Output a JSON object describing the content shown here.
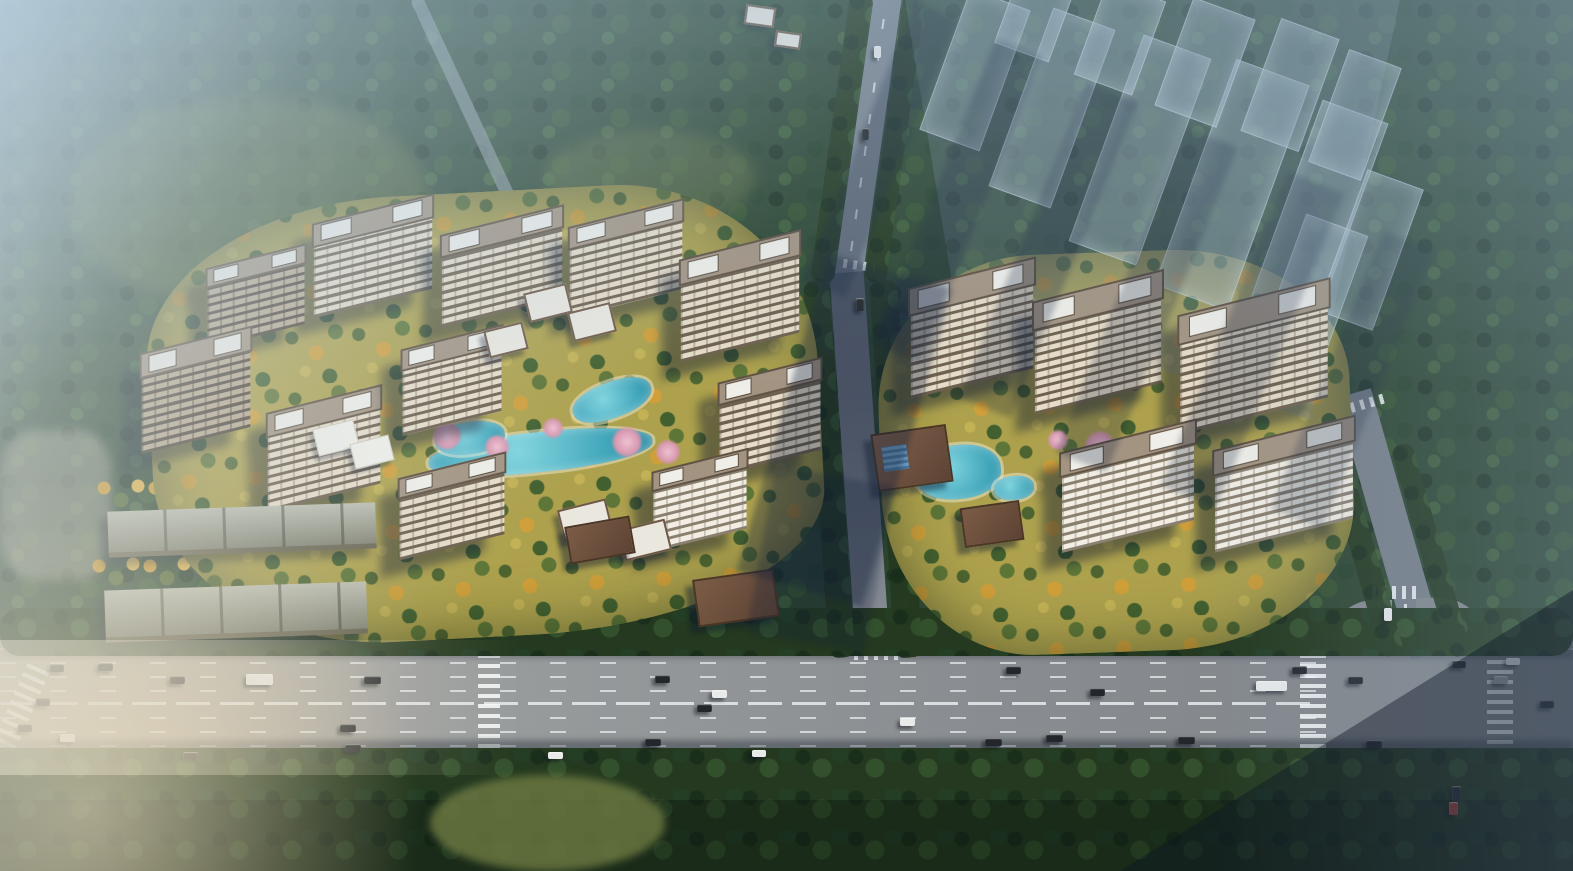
{
  "scene": {
    "title": "Aerial dusk rendering of a two-cluster residential development masterplan beside an urban boulevard",
    "view": "oblique aerial architectural visualization",
    "palette": {
      "forest": "#2c4530",
      "forestDark": "#1e3423",
      "canopyHi": "#3c5c37",
      "meadow": "#5c6c3e",
      "hazeSky": "#cde1ee",
      "hazeBlue": "#94b2cb",
      "roadGray": "#868d93",
      "roadDark": "#59616f",
      "roadWarm": "#b6aa98",
      "laneWhite": "#e8ecee",
      "groundGold": "#ada14d",
      "treeGold": "#cf9a2e",
      "treeGreen": "#4c632f",
      "waterTeal": "#3da3b8",
      "blossomPink": "#d795ad",
      "towerFace": "#e6dcc8",
      "towerDark": "#6e604e",
      "towerRoof": "#a39482",
      "roofWhite": "#efeee8",
      "shedRoof": "#a3a591",
      "ghostFill": "rgba(150,170,186,0.40)",
      "shadowNavy": "rgba(20,33,56,0.35)",
      "carWhite": "#e8eaea",
      "carDark": "#23272c",
      "carGray": "#9aa2a8",
      "carRed": "#9c3a32",
      "glareWarm": "#f3deb4"
    },
    "clusters": [
      {
        "id": "west",
        "towers": 11,
        "features": [
          "winding turquoise ponds",
          "golden trees",
          "blossom trees",
          "white-roof villas",
          "courts",
          "south gate pavilion"
        ]
      },
      {
        "id": "east",
        "towers": 5,
        "features": [
          "clubhouse with glass roof",
          "swimming pool",
          "gate pavilion",
          "tree-clump lawn"
        ]
      }
    ],
    "buildings": [
      {
        "kind": "tower",
        "cx": 373,
        "cy": 256,
        "w": 122,
        "h": 92,
        "rot": -14,
        "tone": "light"
      },
      {
        "kind": "tower",
        "cx": 502,
        "cy": 266,
        "w": 124,
        "h": 90,
        "rot": -14,
        "tone": "light"
      },
      {
        "kind": "tower",
        "cx": 626,
        "cy": 258,
        "w": 116,
        "h": 88,
        "rot": -14,
        "tone": "light"
      },
      {
        "kind": "tower",
        "cx": 256,
        "cy": 296,
        "w": 100,
        "h": 78,
        "rot": -14,
        "tone": "dark"
      },
      {
        "kind": "tower",
        "cx": 196,
        "cy": 390,
        "w": 112,
        "h": 98,
        "rot": -14,
        "tone": "dark"
      },
      {
        "kind": "tower",
        "cx": 324,
        "cy": 448,
        "w": 116,
        "h": 96,
        "rot": -14,
        "tone": "light"
      },
      {
        "kind": "tower",
        "cx": 452,
        "cy": 380,
        "w": 102,
        "h": 84,
        "rot": -14,
        "tone": "light"
      },
      {
        "kind": "tower",
        "cx": 740,
        "cy": 296,
        "w": 122,
        "h": 100,
        "rot": -14,
        "tone": "light"
      },
      {
        "kind": "tower",
        "cx": 770,
        "cy": 416,
        "w": 104,
        "h": 90,
        "rot": -14,
        "tone": "light"
      },
      {
        "kind": "tower",
        "cx": 700,
        "cy": 500,
        "w": 96,
        "h": 78,
        "rot": -14,
        "tone": "bright"
      },
      {
        "kind": "tower",
        "cx": 452,
        "cy": 506,
        "w": 108,
        "h": 80,
        "rot": -14,
        "tone": "light"
      },
      {
        "kind": "tower",
        "cx": 972,
        "cy": 328,
        "w": 126,
        "h": 108,
        "rot": -14,
        "tone": "light"
      },
      {
        "kind": "tower",
        "cx": 1098,
        "cy": 342,
        "w": 130,
        "h": 110,
        "rot": -14,
        "tone": "light"
      },
      {
        "kind": "tower",
        "cx": 1254,
        "cy": 356,
        "w": 152,
        "h": 116,
        "rot": -14,
        "tone": "light"
      },
      {
        "kind": "tower",
        "cx": 1128,
        "cy": 486,
        "w": 136,
        "h": 98,
        "rot": -14,
        "tone": "bright"
      },
      {
        "kind": "tower",
        "cx": 1284,
        "cy": 484,
        "w": 142,
        "h": 100,
        "rot": -14,
        "tone": "bright"
      },
      {
        "kind": "villa",
        "cx": 548,
        "cy": 303,
        "w": 44,
        "h": 30,
        "rot": -14
      },
      {
        "kind": "villa",
        "cx": 592,
        "cy": 322,
        "w": 44,
        "h": 30,
        "rot": -14
      },
      {
        "kind": "villa",
        "cx": 506,
        "cy": 340,
        "w": 40,
        "h": 28,
        "rot": -14
      },
      {
        "kind": "villa",
        "cx": 585,
        "cy": 520,
        "w": 50,
        "h": 32,
        "rot": -14
      },
      {
        "kind": "villa",
        "cx": 645,
        "cy": 540,
        "w": 48,
        "h": 32,
        "rot": -14
      },
      {
        "kind": "villa",
        "cx": 760,
        "cy": 16,
        "w": 30,
        "h": 20,
        "rot": 8
      },
      {
        "kind": "villa",
        "cx": 788,
        "cy": 40,
        "w": 26,
        "h": 16,
        "rot": 8
      },
      {
        "kind": "court",
        "cx": 336,
        "cy": 438,
        "w": 42,
        "h": 28,
        "rot": -14
      },
      {
        "kind": "court",
        "cx": 372,
        "cy": 452,
        "w": 40,
        "h": 26,
        "rot": -14
      },
      {
        "kind": "gate",
        "cx": 600,
        "cy": 540,
        "w": 66,
        "h": 38,
        "rot": -10
      },
      {
        "kind": "gate",
        "cx": 736,
        "cy": 598,
        "w": 82,
        "h": 48,
        "rot": -8
      },
      {
        "kind": "gate",
        "cx": 992,
        "cy": 524,
        "w": 60,
        "h": 40,
        "rot": -8
      },
      {
        "kind": "clubhouse",
        "cx": 912,
        "cy": 458,
        "w": 76,
        "h": 58,
        "rot": -8
      },
      {
        "kind": "shed",
        "cx": 242,
        "cy": 530,
        "w": 268,
        "h": 46,
        "rot": -2
      },
      {
        "kind": "shed",
        "cx": 236,
        "cy": 612,
        "w": 262,
        "h": 52,
        "rot": -2
      }
    ],
    "ghost_blocks": [
      {
        "cx": 975,
        "cy": 70,
        "w": 64,
        "h": 150,
        "rot": 20
      },
      {
        "cx": 1052,
        "cy": 108,
        "w": 66,
        "h": 190,
        "rot": 20
      },
      {
        "cx": 1140,
        "cy": 150,
        "w": 72,
        "h": 220,
        "rot": 20
      },
      {
        "cx": 1232,
        "cy": 185,
        "w": 78,
        "h": 240,
        "rot": 20
      },
      {
        "cx": 1318,
        "cy": 215,
        "w": 70,
        "h": 220,
        "rot": 20
      },
      {
        "cx": 1035,
        "cy": 15,
        "w": 58,
        "h": 80,
        "rot": 20
      },
      {
        "cx": 1120,
        "cy": 38,
        "w": 62,
        "h": 100,
        "rot": 20
      },
      {
        "cx": 1205,
        "cy": 62,
        "w": 66,
        "h": 115,
        "rot": 20
      },
      {
        "cx": 1290,
        "cy": 85,
        "w": 62,
        "h": 120,
        "rot": 20
      },
      {
        "cx": 1355,
        "cy": 115,
        "w": 56,
        "h": 120,
        "rot": 20
      },
      {
        "cx": 1310,
        "cy": 300,
        "w": 66,
        "h": 160,
        "rot": 20
      },
      {
        "cx": 1370,
        "cy": 250,
        "w": 60,
        "h": 150,
        "rot": 20
      }
    ],
    "shadow_bands": [
      {
        "cx": 880,
        "cy": 150,
        "w": 46,
        "h": 300,
        "rot": 22,
        "op": 0.3
      },
      {
        "cx": 958,
        "cy": 200,
        "w": 50,
        "h": 330,
        "rot": 22,
        "op": 0.28
      },
      {
        "cx": 1048,
        "cy": 250,
        "w": 55,
        "h": 340,
        "rot": 22,
        "op": 0.28
      },
      {
        "cx": 1146,
        "cy": 300,
        "w": 55,
        "h": 350,
        "rot": 22,
        "op": 0.26
      },
      {
        "cx": 1252,
        "cy": 340,
        "w": 60,
        "h": 340,
        "rot": 22,
        "op": 0.26
      },
      {
        "cx": 1352,
        "cy": 380,
        "w": 55,
        "h": 300,
        "rot": 22,
        "op": 0.24
      },
      {
        "cx": 845,
        "cy": 430,
        "w": 130,
        "h": 330,
        "rot": 16,
        "op": 0.36
      },
      {
        "cx": 820,
        "cy": 560,
        "w": 120,
        "h": 170,
        "rot": 10,
        "op": 0.26
      }
    ],
    "water": [
      {
        "cx": 540,
        "cy": 452,
        "w": 225,
        "h": 40,
        "rot": -6
      },
      {
        "cx": 612,
        "cy": 400,
        "w": 82,
        "h": 36,
        "rot": -20
      },
      {
        "cx": 470,
        "cy": 438,
        "w": 70,
        "h": 32,
        "rot": -8
      },
      {
        "cx": 958,
        "cy": 472,
        "w": 86,
        "h": 54,
        "rot": -6
      },
      {
        "cx": 1014,
        "cy": 488,
        "w": 40,
        "h": 24,
        "rot": -6
      }
    ],
    "blossoms": [
      {
        "cx": 447,
        "cy": 436,
        "r": 14
      },
      {
        "cx": 497,
        "cy": 447,
        "r": 12
      },
      {
        "cx": 627,
        "cy": 442,
        "r": 15
      },
      {
        "cx": 668,
        "cy": 452,
        "r": 12
      },
      {
        "cx": 553,
        "cy": 428,
        "r": 10
      },
      {
        "cx": 1100,
        "cy": 446,
        "r": 15
      },
      {
        "cx": 1058,
        "cy": 440,
        "r": 10
      }
    ],
    "vehicles": [
      {
        "x": 98,
        "y": 663,
        "w": 15,
        "h": 8,
        "c": "carDark"
      },
      {
        "x": 170,
        "y": 676,
        "w": 15,
        "h": 8,
        "c": "carDark"
      },
      {
        "x": 246,
        "y": 674,
        "w": 27,
        "h": 11,
        "c": "carWhite"
      },
      {
        "x": 364,
        "y": 676,
        "w": 17,
        "h": 8,
        "c": "carDark"
      },
      {
        "x": 655,
        "y": 675,
        "w": 15,
        "h": 8,
        "c": "carDark"
      },
      {
        "x": 712,
        "y": 690,
        "w": 15,
        "h": 8,
        "c": "carWhite"
      },
      {
        "x": 697,
        "y": 704,
        "w": 15,
        "h": 8,
        "c": "carDark"
      },
      {
        "x": 1006,
        "y": 666,
        "w": 15,
        "h": 8,
        "c": "carDark"
      },
      {
        "x": 1090,
        "y": 688,
        "w": 15,
        "h": 8,
        "c": "carDark"
      },
      {
        "x": 1292,
        "y": 666,
        "w": 15,
        "h": 8,
        "c": "carDark"
      },
      {
        "x": 1348,
        "y": 676,
        "w": 15,
        "h": 8,
        "c": "carDark"
      },
      {
        "x": 1452,
        "y": 660,
        "w": 14,
        "h": 8,
        "c": "carDark"
      },
      {
        "x": 1506,
        "y": 658,
        "w": 14,
        "h": 7,
        "c": "carWhite"
      },
      {
        "x": 1494,
        "y": 676,
        "w": 14,
        "h": 8,
        "c": "carGray"
      },
      {
        "x": 1540,
        "y": 700,
        "w": 14,
        "h": 8,
        "c": "carDark"
      },
      {
        "x": 50,
        "y": 664,
        "w": 14,
        "h": 8,
        "c": "carDark"
      },
      {
        "x": 36,
        "y": 698,
        "w": 14,
        "h": 8,
        "c": "carDark"
      },
      {
        "x": 18,
        "y": 724,
        "w": 14,
        "h": 8,
        "c": "carDark"
      },
      {
        "x": 60,
        "y": 734,
        "w": 15,
        "h": 8,
        "c": "carWhite"
      },
      {
        "x": 340,
        "y": 724,
        "w": 16,
        "h": 8,
        "c": "carDark"
      },
      {
        "x": 345,
        "y": 744,
        "w": 16,
        "h": 8,
        "c": "carDark"
      },
      {
        "x": 183,
        "y": 752,
        "w": 15,
        "h": 7,
        "c": "carDark"
      },
      {
        "x": 548,
        "y": 752,
        "w": 15,
        "h": 7,
        "c": "carWhite"
      },
      {
        "x": 645,
        "y": 738,
        "w": 16,
        "h": 8,
        "c": "carDark"
      },
      {
        "x": 752,
        "y": 750,
        "w": 14,
        "h": 7,
        "c": "carWhite"
      },
      {
        "x": 900,
        "y": 718,
        "w": 15,
        "h": 8,
        "c": "carWhite"
      },
      {
        "x": 985,
        "y": 738,
        "w": 17,
        "h": 8,
        "c": "carDark"
      },
      {
        "x": 1046,
        "y": 734,
        "w": 17,
        "h": 8,
        "c": "carDark"
      },
      {
        "x": 1178,
        "y": 736,
        "w": 17,
        "h": 8,
        "c": "carDark"
      },
      {
        "x": 1366,
        "y": 740,
        "w": 16,
        "h": 8,
        "c": "carDark"
      },
      {
        "x": 1256,
        "y": 681,
        "w": 31,
        "h": 10,
        "c": "carWhite"
      },
      {
        "x": 1384,
        "y": 608,
        "w": 8,
        "h": 13,
        "c": "carWhite"
      },
      {
        "x": 1452,
        "y": 786,
        "w": 9,
        "h": 15,
        "c": "carDark"
      },
      {
        "x": 1449,
        "y": 802,
        "w": 9,
        "h": 13,
        "c": "carRed"
      },
      {
        "x": 874,
        "y": 46,
        "w": 7,
        "h": 12,
        "c": "carWhite"
      },
      {
        "x": 862,
        "y": 128,
        "w": 7,
        "h": 12,
        "c": "carDark"
      },
      {
        "x": 856,
        "y": 298,
        "w": 8,
        "h": 13,
        "c": "carDark"
      }
    ]
  }
}
